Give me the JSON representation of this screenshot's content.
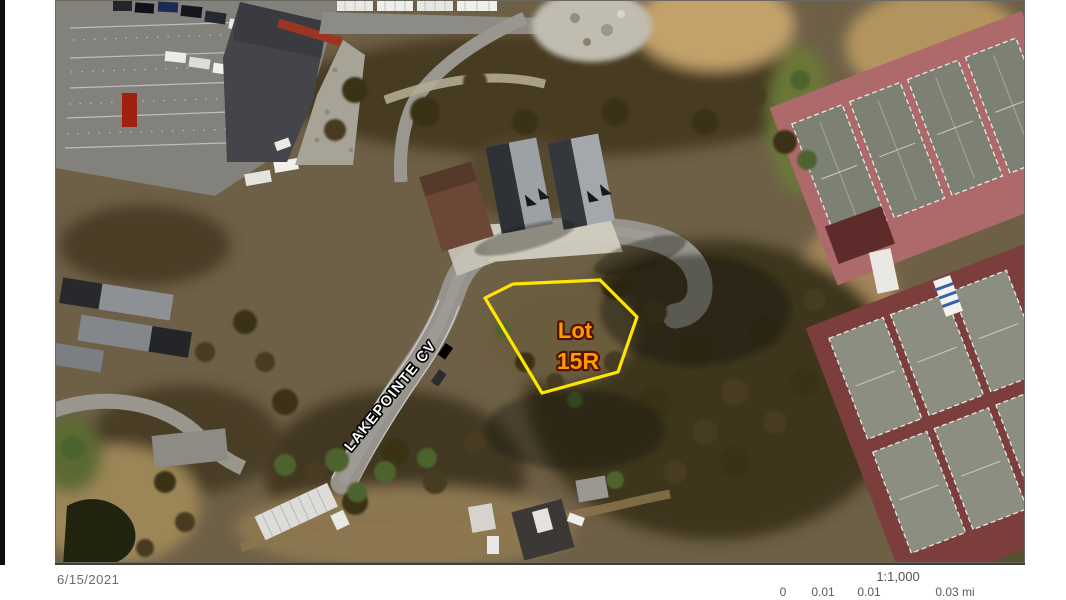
{
  "map": {
    "lot_label": {
      "line1": "Lot",
      "line2": "15R"
    },
    "street_label": "LAKEPOINTE CV",
    "colors": {
      "lot_outline": "#ffe600",
      "lot_label_fill": "#ff9b00",
      "lot_label_outline": "#551400",
      "street_label_fill": "#ffffff",
      "street_label_outline": "#000000"
    }
  },
  "footer": {
    "date": "6/15/2021",
    "scale_text": "1:1,000",
    "scale_bar_labels": [
      "0",
      "0.01",
      "0.01",
      "0.03 mi"
    ]
  }
}
